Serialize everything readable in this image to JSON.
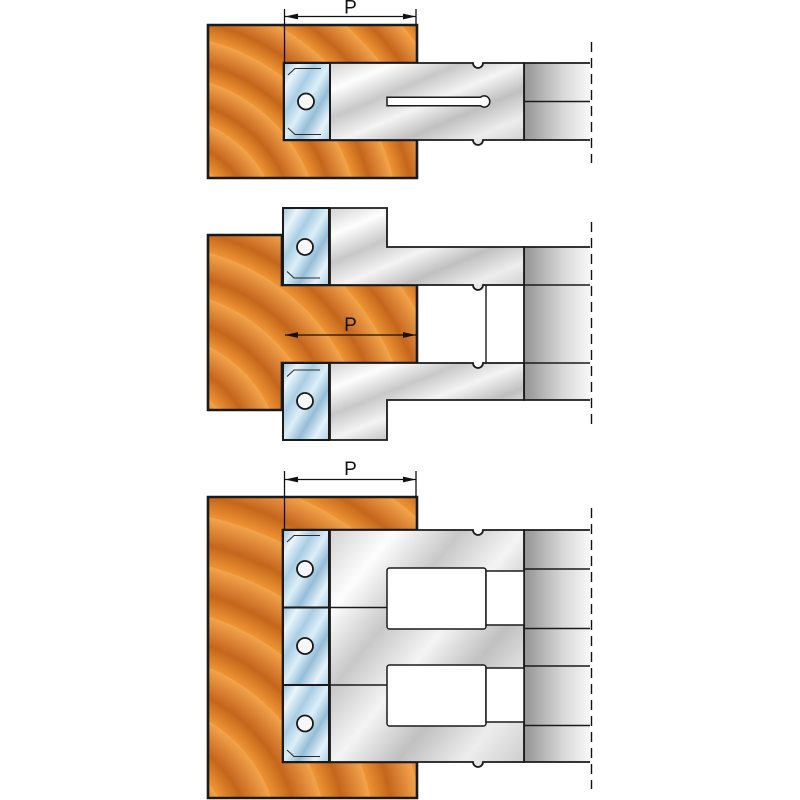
{
  "image_type": "cutter-head technical illustration, three configurations",
  "background": "#ffffff",
  "colors": {
    "outline": "#1a1a1a",
    "wood_rings": [
      "#ee9434",
      "#c4661b",
      "#d0742a",
      "#f3a44b"
    ],
    "steel": [
      "#d2d2d2",
      "#fdfdfd",
      "#c8c8c8",
      "#f4f4f4",
      "#c0c0c0",
      "#ededed",
      "#cccccc"
    ],
    "insert_blue": [
      "#9dc2da",
      "#e9f5fb",
      "#a9cde3",
      "#dceff8",
      "#95bdd7",
      "#e4f2fa",
      "#abcfe4"
    ],
    "hub": [
      "#949494",
      "#d9d9d9",
      "#f7f7f7"
    ],
    "slot_fill": "#ffffff",
    "hole_fill": "#f7f7f7"
  },
  "diagrams": [
    {
      "id": "groove-cut",
      "cutters": 1,
      "dimension_label": "P"
    },
    {
      "id": "tongue-cut",
      "cutters": 2,
      "dimension_label": "P"
    },
    {
      "id": "rabbet-cut",
      "cutters": 3,
      "dimension_label": "P"
    }
  ]
}
